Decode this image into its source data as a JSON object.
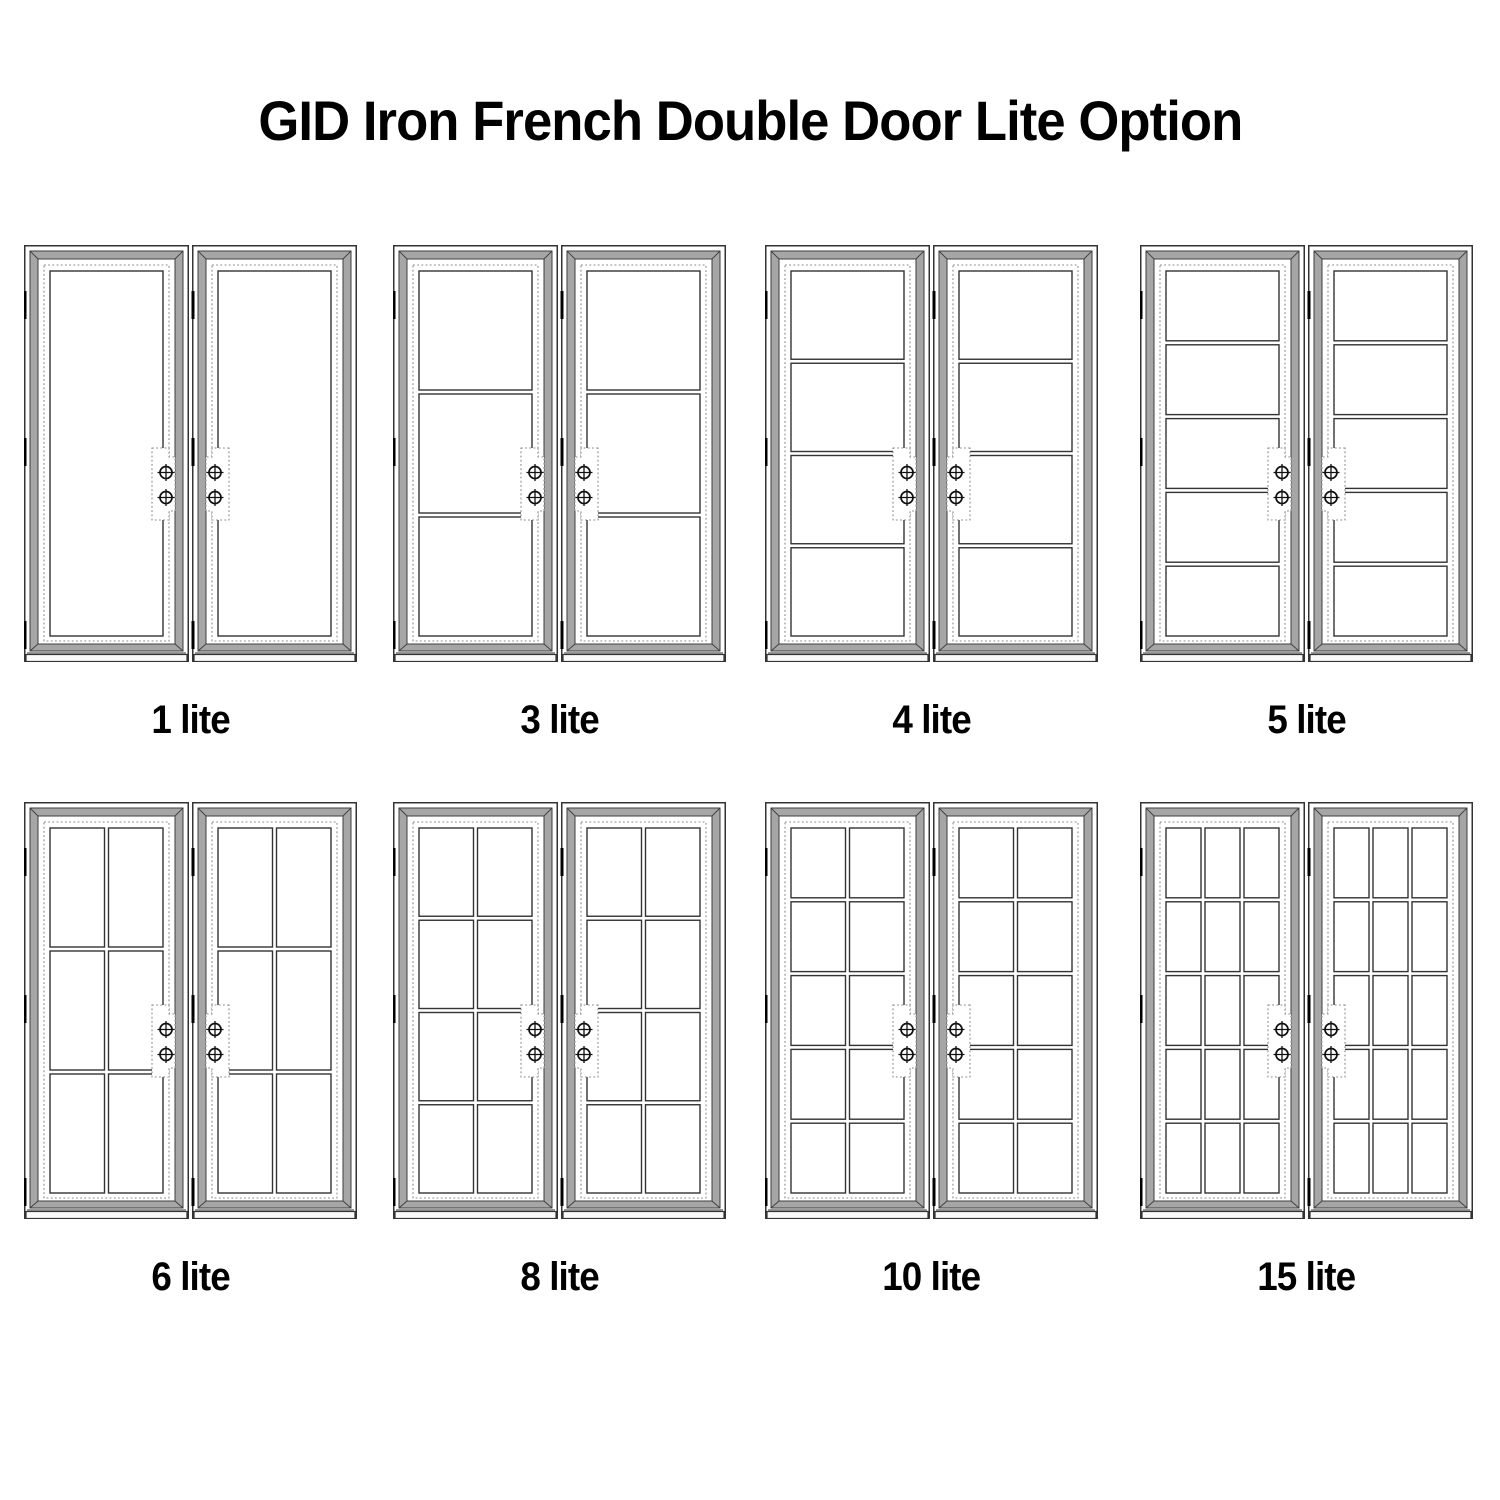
{
  "title": "GID Iron French Double Door Lite Option",
  "options": [
    {
      "label": "1 lite",
      "rows": 1,
      "cols": 1
    },
    {
      "label": "3 lite",
      "rows": 3,
      "cols": 1
    },
    {
      "label": "4 lite",
      "rows": 4,
      "cols": 1
    },
    {
      "label": "5 lite",
      "rows": 5,
      "cols": 1
    },
    {
      "label": "6 lite",
      "rows": 3,
      "cols": 2
    },
    {
      "label": "8 lite",
      "rows": 4,
      "cols": 2
    },
    {
      "label": "10 lite",
      "rows": 5,
      "cols": 2
    },
    {
      "label": "15 lite",
      "rows": 5,
      "cols": 3
    }
  ],
  "door": {
    "leaves_per_unit": 2,
    "screws_per_handle_plate": 2,
    "hinge_marks_per_leaf": 3
  },
  "style": {
    "line_color": "#333333",
    "band_fill": "#a6a6a6",
    "band_line": "#3d3d3d",
    "dash_color": "#8a8a8a",
    "hinge_color": "#000000",
    "glass_fill": "#ffffff",
    "threshold_fill": "#fafafa"
  }
}
